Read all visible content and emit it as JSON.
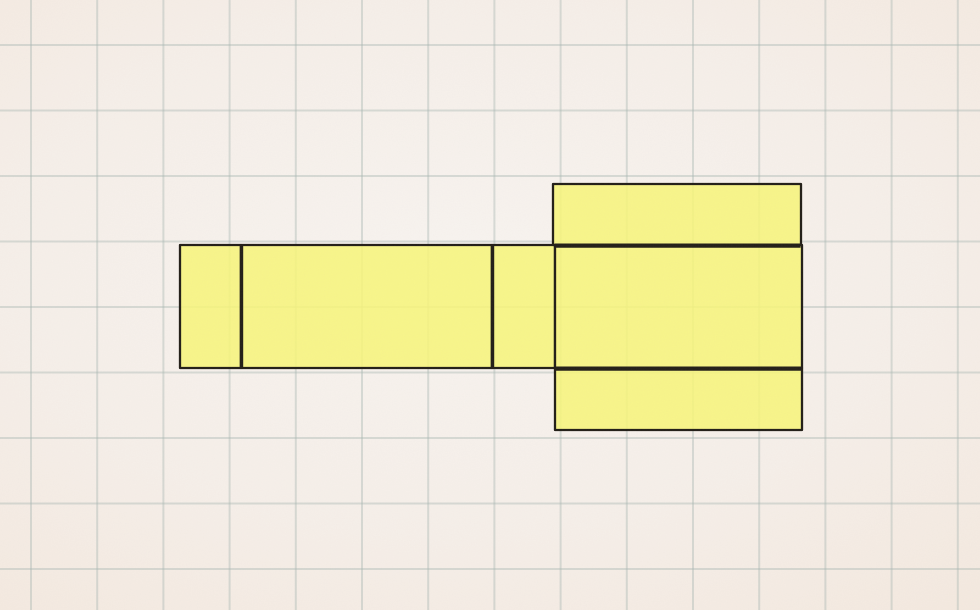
{
  "canvas": {
    "width": 980,
    "height": 610
  },
  "background": {
    "paper_color_center": "#f8f4f0",
    "paper_color_edge": "#f1e3d6",
    "grid": {
      "color": "#a9b8b2",
      "opacity": 0.42,
      "line_width": 2,
      "offset_x": 31,
      "spacing_x": 66.2,
      "offset_y": 45,
      "spacing_y": 65.5
    },
    "texture_opacity": 0.055
  },
  "net": {
    "fill": "#f8f679",
    "fill_opacity": 0.86,
    "stroke": "#221e17",
    "outline_width": 2.3,
    "fold_line_width": 4.2,
    "panels": [
      {
        "name": "left-end-flap",
        "x": 180,
        "y": 245,
        "w": 61,
        "h": 123
      },
      {
        "name": "top-face",
        "x": 241,
        "y": 245,
        "w": 251,
        "h": 123
      },
      {
        "name": "side-face",
        "x": 492,
        "y": 245,
        "w": 63,
        "h": 123
      },
      {
        "name": "bottom-face",
        "x": 555,
        "y": 245,
        "w": 247,
        "h": 123
      },
      {
        "name": "top-flap",
        "x": 553,
        "y": 184,
        "w": 248,
        "h": 61
      },
      {
        "name": "bottom-flap",
        "x": 555,
        "y": 368,
        "w": 247,
        "h": 62
      }
    ],
    "fold_lines": [
      {
        "name": "left-end-flap-crease",
        "x1": 241.5,
        "y1": 246,
        "x2": 241.5,
        "y2": 367,
        "width": 3.4
      },
      {
        "name": "side-face-crease",
        "x1": 492.5,
        "y1": 246,
        "x2": 492.5,
        "y2": 367,
        "width": 3.4
      },
      {
        "name": "top-flap-crease",
        "x1": 554.5,
        "y1": 245.6,
        "x2": 800.5,
        "y2": 245.6,
        "width": 4.2
      },
      {
        "name": "bottom-flap-crease",
        "x1": 554.5,
        "y1": 368.6,
        "x2": 801.5,
        "y2": 368.6,
        "width": 4.2
      }
    ]
  }
}
